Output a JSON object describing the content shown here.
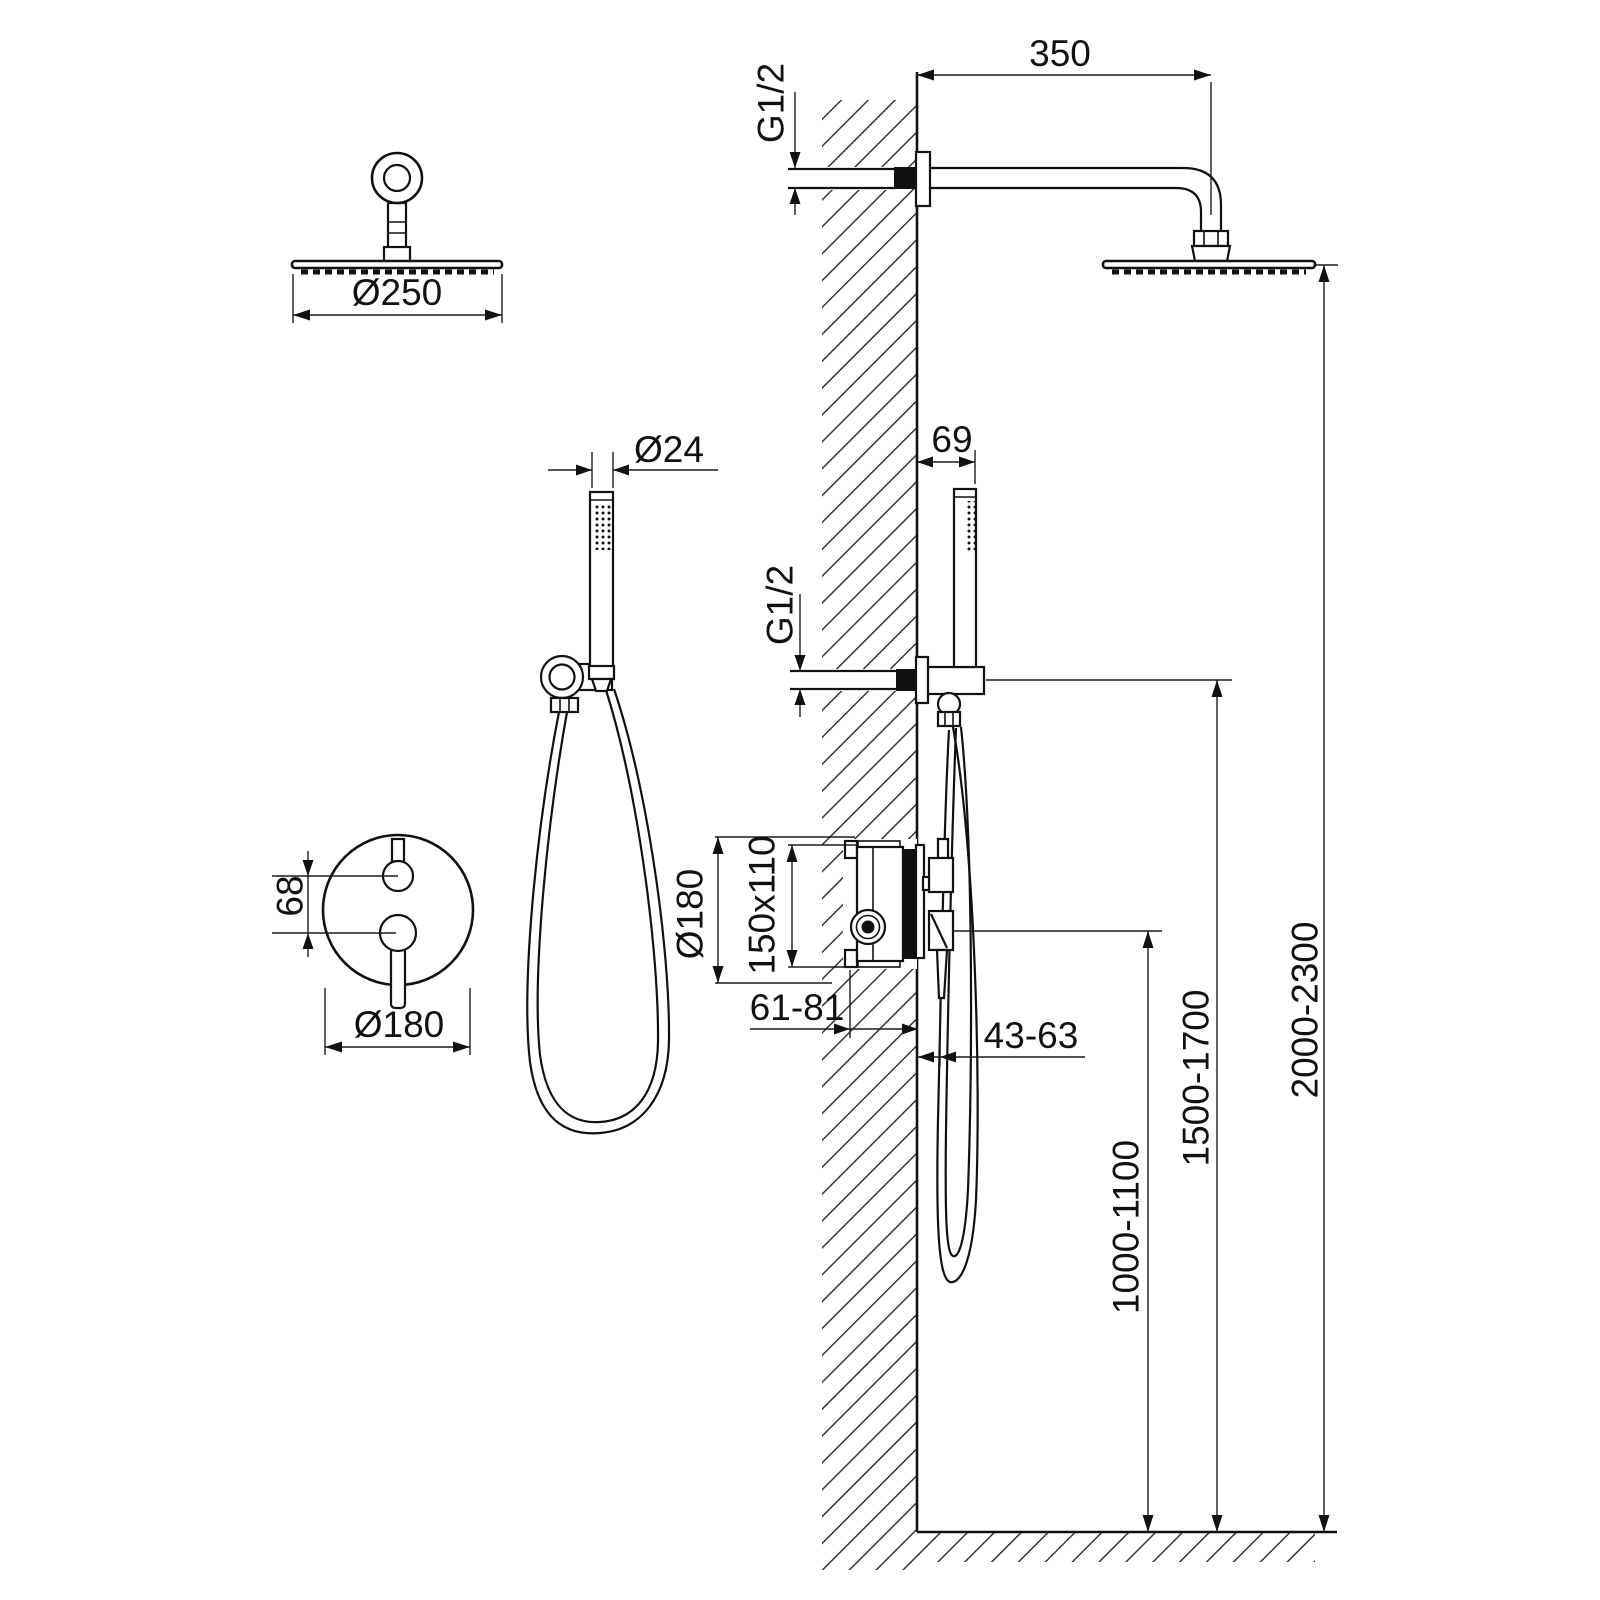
{
  "drawing": {
    "type": "shower-system-installation-dimensions",
    "line_color": "#111111",
    "background": "#ffffff"
  },
  "labels": {
    "head_diameter": "Ø250",
    "handshower_diameter": "Ø24",
    "mixer_handle_spacing": "68",
    "mixer_plate_diameter": "Ø180",
    "top_connection_thread": "G1/2",
    "arm_length": "350",
    "holder_offset": "69",
    "mid_connection_thread": "G1/2",
    "valve_trim_diameter": "Ø180",
    "valve_box_size": "150x110",
    "valve_depth_range": "61-81",
    "trim_depth_range": "43-63",
    "valve_height_range": "1000-1100",
    "holder_height_range": "1500-1700",
    "head_height_range": "2000-2300"
  }
}
